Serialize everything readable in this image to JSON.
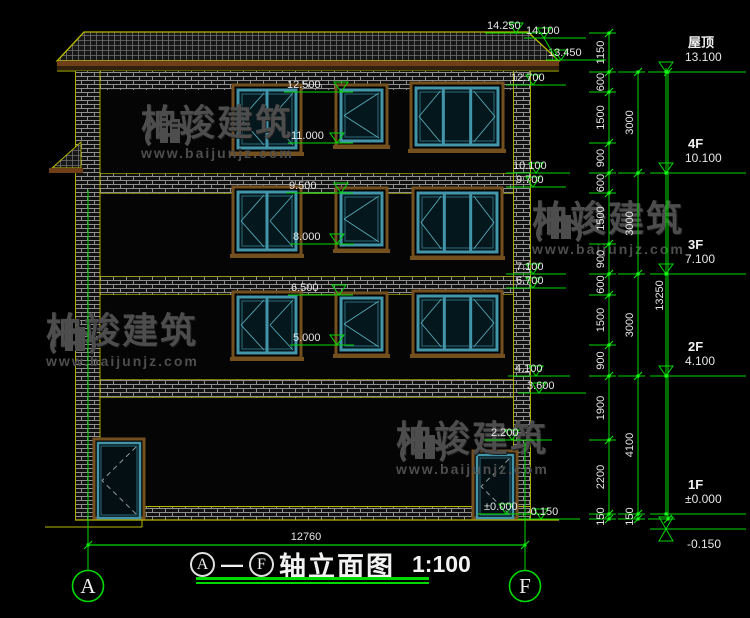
{
  "drawing": {
    "type": "building-elevation",
    "title": {
      "axis_start": "A",
      "axis_end": "F",
      "name": "轴立面图",
      "scale": "1:100"
    },
    "ground_dimension": "12760",
    "axis_bubbles": [
      {
        "label": "A"
      },
      {
        "label": "F"
      }
    ]
  },
  "watermark": {
    "brand": "柏竣建筑",
    "site": "www.baijunjz.com"
  },
  "floor_flags": [
    {
      "name": "屋顶",
      "value": "13.100"
    },
    {
      "name": "4F",
      "value": "10.100"
    },
    {
      "name": "3F",
      "value": "7.100"
    },
    {
      "name": "2F",
      "value": "4.100"
    },
    {
      "name": "1F",
      "value": "±0.000"
    },
    {
      "name": "",
      "value": "-0.150"
    }
  ],
  "elevation_marks": [
    "14.250",
    "14.100",
    "13.450",
    "12.700",
    "12.500",
    "11.000",
    "10.100",
    "9.700",
    "9.500",
    "8.000",
    "7.100",
    "6.700",
    "6.500",
    "5.000",
    "4.100",
    "3.600",
    "2.200",
    "±0.000",
    "-0.150"
  ],
  "dimension_chains": {
    "inner": [
      "1150",
      "600",
      "1500",
      "900",
      "600",
      "1500",
      "900",
      "600",
      "1500",
      "900",
      "1900",
      "2200",
      "150"
    ],
    "middle": [
      "3000",
      "3000",
      "3000",
      "4100",
      "150"
    ],
    "outer": [
      "13250"
    ]
  },
  "colors": {
    "dimension_green": "#00d900",
    "outline_yellow": "#b9b900",
    "window_teal": "#4395aa",
    "surround_brown": "#75501f",
    "text_white": "#e6e6e6",
    "watermark_gray": "#4d4d4d"
  }
}
